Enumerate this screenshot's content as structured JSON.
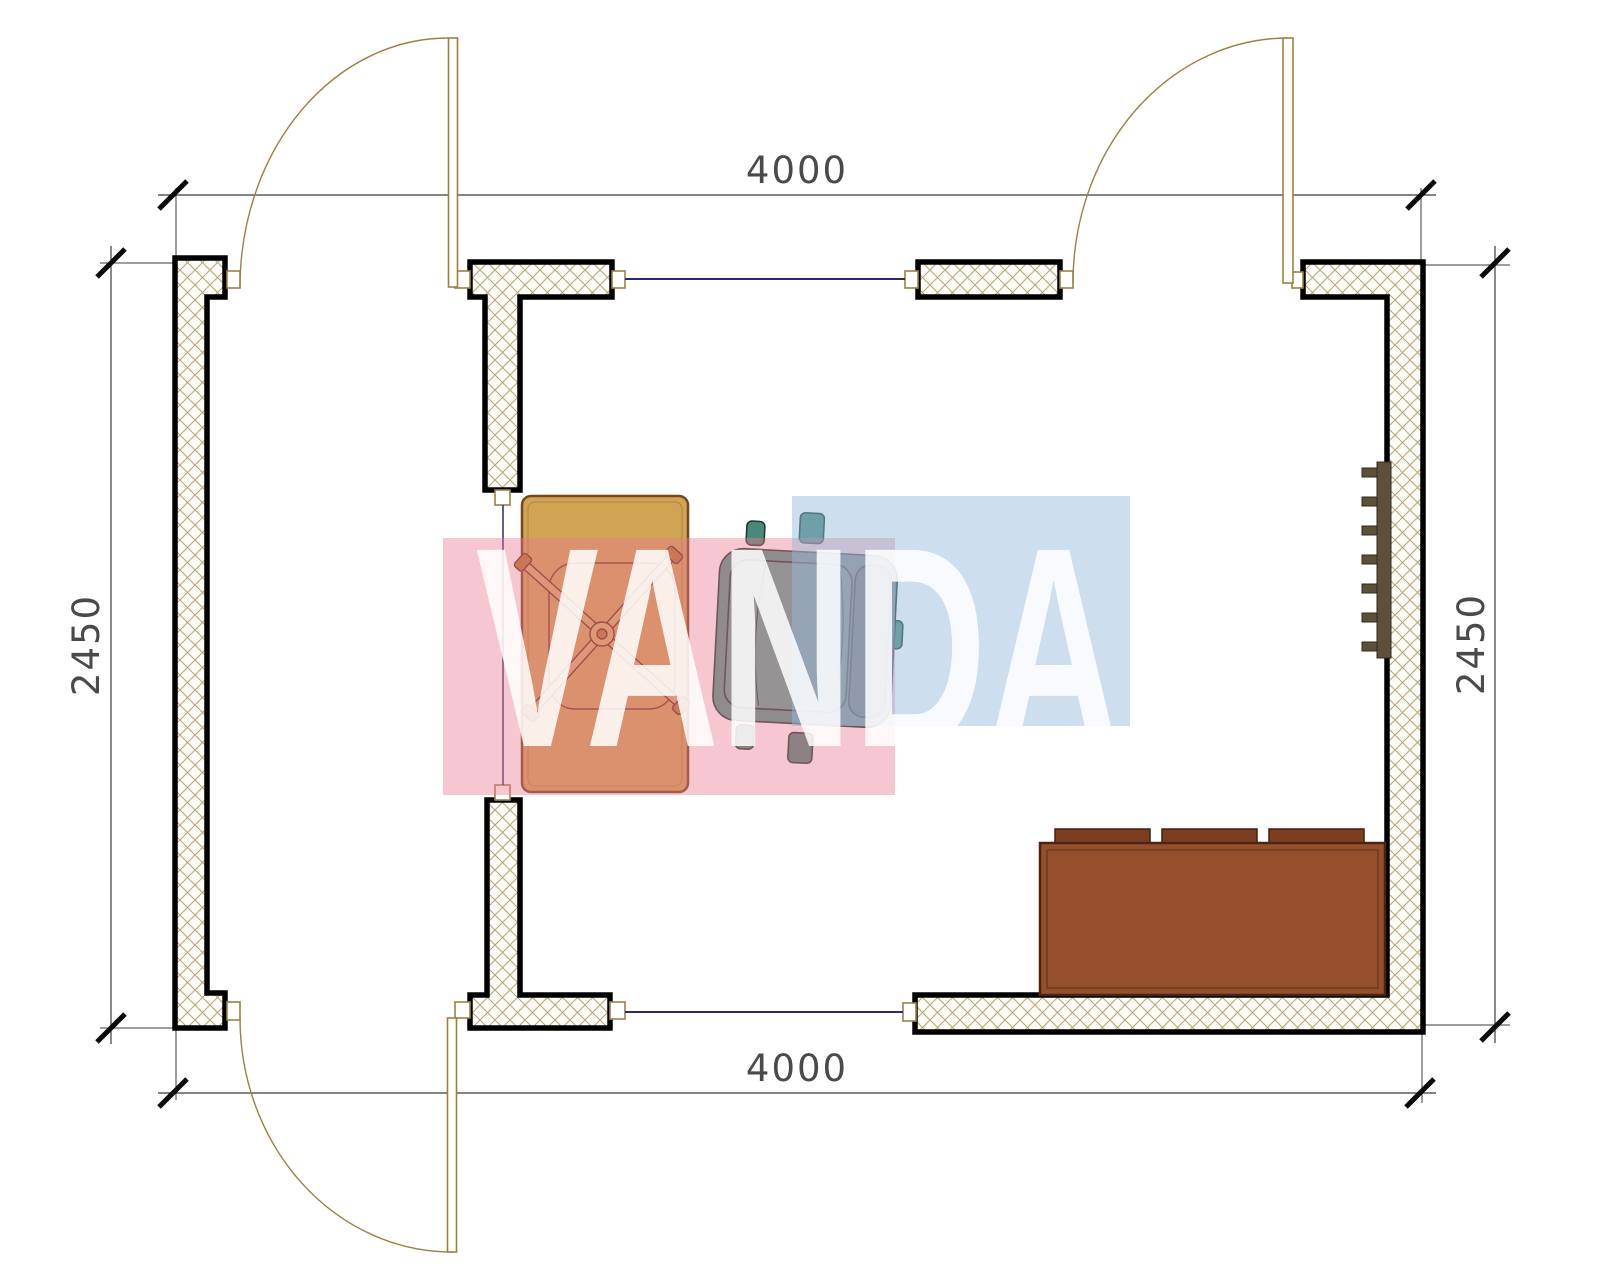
{
  "document": {
    "type": "architectural-floor-plan",
    "watermark_text": "VANDA"
  },
  "dimension_labels": {
    "top": "4000",
    "bottom": "4000",
    "left": "2450",
    "right": "2450"
  },
  "walls": {
    "style": "crosshatched with black outline",
    "count": 5,
    "doors": 3,
    "windows": 2
  },
  "furniture": [
    {
      "name": "desk"
    },
    {
      "name": "office-chair"
    },
    {
      "name": "armchair"
    },
    {
      "name": "sofa"
    },
    {
      "name": "radiator"
    }
  ],
  "colors": {
    "background": "#ffffff",
    "wall_outline": "#000000",
    "hatch_line": "#b6a77e",
    "door_line": "#9b8044",
    "window_line": "#2b2b66",
    "dim_line": "#3c3c3c",
    "dim_text": "#4a4a4a",
    "desk": "#d1a355",
    "desk_border": "#74471c",
    "chair_cross": "#d8ae67",
    "chair_cross_border": "#6b3020",
    "armchair": "#4f998c",
    "armchair_dark": "#428076",
    "armchair_light": "#58a597",
    "sofa_body": "#94502c",
    "sofa_cushion": "#7c3e20",
    "sofa_border": "#4a2413",
    "radiator": "#5c5138",
    "watermark_pink": "rgba(234,122,144,0.42)",
    "watermark_blue": "rgba(150,185,220,0.48)",
    "watermark_letters": "rgba(255,255,255,0.85)"
  }
}
